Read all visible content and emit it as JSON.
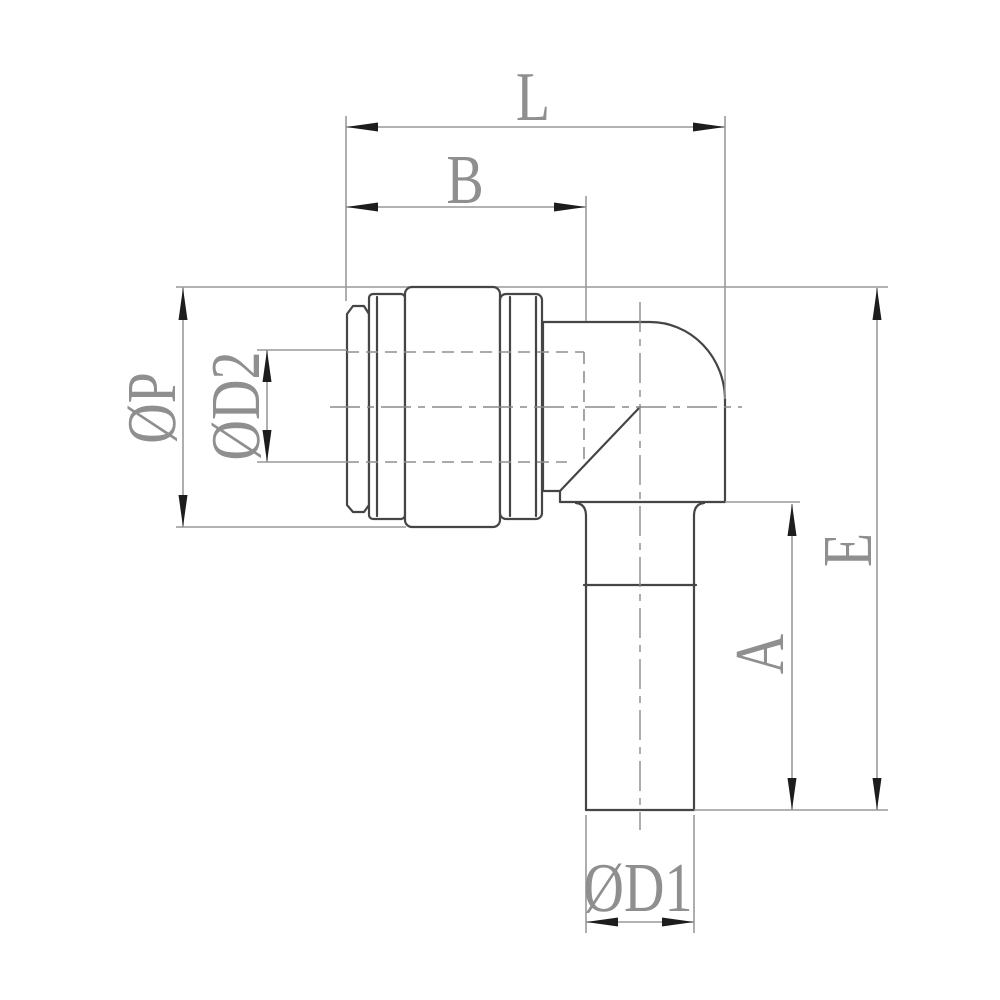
{
  "drawing": {
    "dimension_labels": {
      "overall_length": "L",
      "cap_length": "B",
      "cap_outer_diameter": "ØP",
      "tube_insert_diameter": "ØD2",
      "stem_length": "A",
      "overall_height": "E",
      "stem_diameter": "ØD1"
    },
    "colors": {
      "background": "#ffffff",
      "outline": "#454545",
      "dimension_line": "#999999",
      "hidden_line": "#8f8f8f",
      "centerline": "#8a8a8a",
      "arrow": "#1d1d1d",
      "label_text": "#8f8f8f"
    }
  }
}
